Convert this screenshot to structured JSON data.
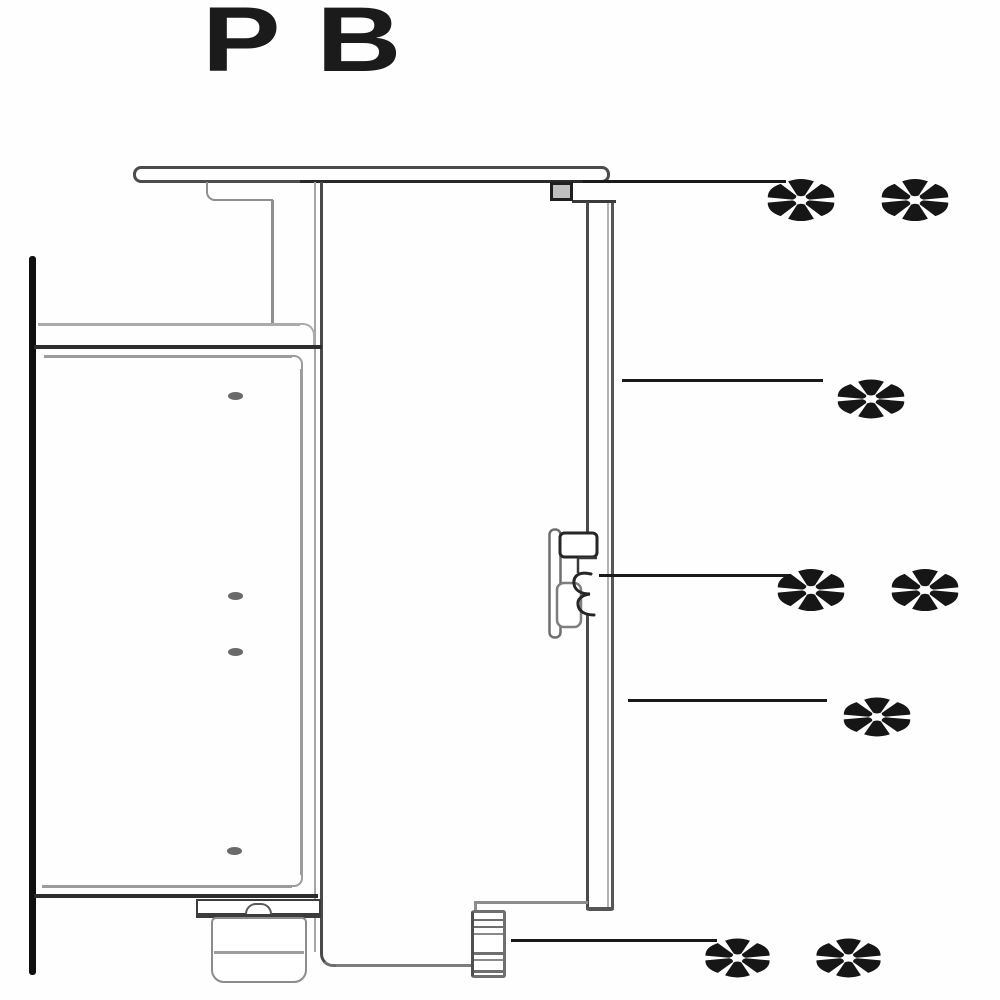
{
  "title": "PB",
  "callouts": [
    {
      "name": "worktop-connector",
      "label": "**"
    },
    {
      "name": "front-panel-upper",
      "label": "*"
    },
    {
      "name": "panel-clip",
      "label": "**"
    },
    {
      "name": "front-panel-lower",
      "label": "*"
    },
    {
      "name": "adjustable-foot",
      "label": "**"
    }
  ],
  "colors": {
    "ink": "#1a1a1a",
    "line_dark": "#2d2d2d",
    "line_gray": "#9c9c9c",
    "background": "#ffffff"
  }
}
